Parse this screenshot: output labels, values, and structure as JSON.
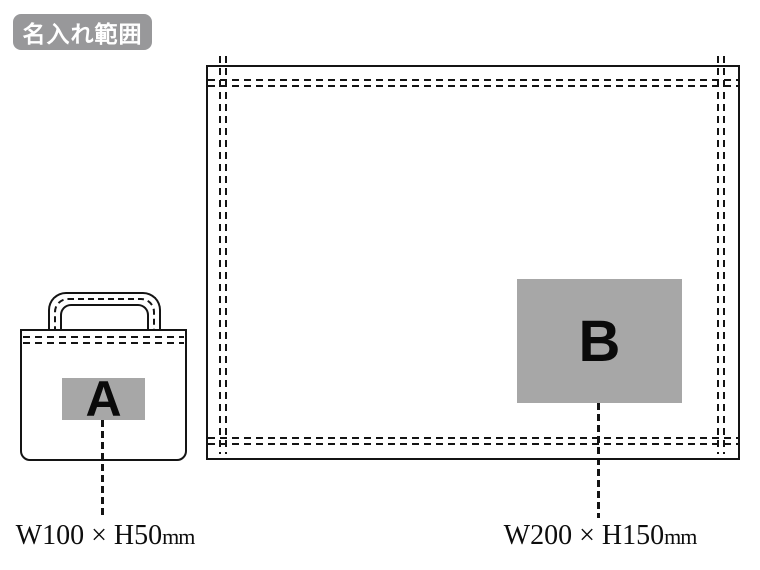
{
  "badge": {
    "label": "名入れ範囲"
  },
  "print_areas": {
    "a": {
      "letter": "A",
      "size_label": "W100 × H50",
      "unit": "mm"
    },
    "b": {
      "letter": "B",
      "size_label": "W200 × H150",
      "unit": "mm"
    }
  },
  "colors": {
    "badge_bg": "#98989a",
    "badge_text": "#ffffff",
    "area_fill": "#a7a7a7",
    "line": "#141414"
  }
}
